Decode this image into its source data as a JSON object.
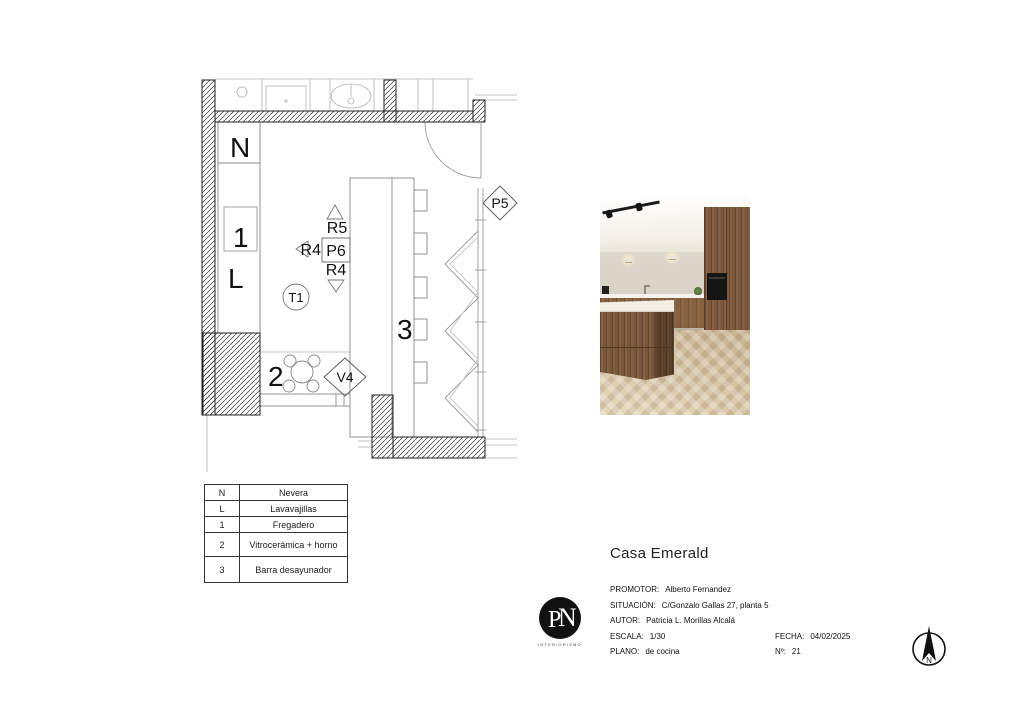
{
  "plan": {
    "labels": {
      "fridge": "N",
      "sink": "1",
      "dishwasher": "L",
      "r5": "R5",
      "r4_left": "R4",
      "p6": "P6",
      "r4_bottom": "R4",
      "t1": "T1",
      "bar": "3",
      "hob": "2",
      "v4": "V4",
      "p5": "P5"
    },
    "colors": {
      "wall_line": "#222222",
      "counter_line": "#888888",
      "light_line": "#b0b0b0"
    }
  },
  "legend": {
    "rows": [
      {
        "key": "N",
        "value": "Nevera"
      },
      {
        "key": "L",
        "value": "Lavavajillas"
      },
      {
        "key": "1",
        "value": "Fregadero"
      },
      {
        "key": "2",
        "value": "Vitrocerámica + horno"
      },
      {
        "key": "3",
        "value": "Barra desayunador"
      }
    ]
  },
  "title_block": {
    "project": "Casa Emerald",
    "promotor_label": "PROMOTOR:",
    "promotor": "Alberto Fernandez",
    "situacion_label": "SITUACIÓN:",
    "situacion": "C/Gonzalo Gallas 27, planta 5",
    "autor_label": "AUTOR:",
    "autor": "Patricia L. Morillas Alcalá",
    "escala_label": "ESCALA:",
    "escala": "1/30",
    "fecha_label": "FECHA:",
    "fecha": "04/02/2025",
    "plano_label": "PLANO:",
    "plano": "de cocina",
    "numero_label": "Nº:",
    "numero": "21"
  },
  "logo": {
    "monogram_p": "P",
    "monogram_n": "N",
    "subtitle": "INTERIORISMO"
  },
  "north_arrow": {
    "label": "N"
  }
}
